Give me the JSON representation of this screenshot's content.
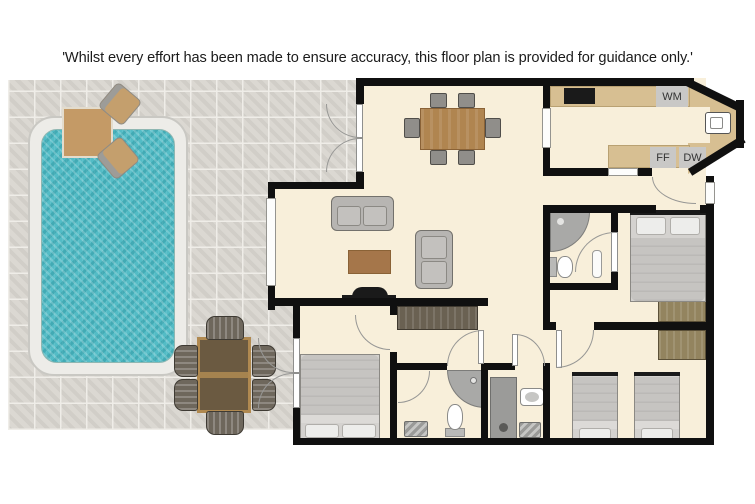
{
  "disclaimer": "'Whilst every effort has been made to ensure accuracy, this floor plan is provided for guidance only.'",
  "labels": {
    "washing_machine": "WM",
    "fridge_freezer": "FF",
    "dishwasher": "DW"
  },
  "colors": {
    "wall": "#101010",
    "floor": "#f8efda",
    "tile": "#dbd8d2",
    "tile_grout": "#efede8",
    "counter": "#d7bf92",
    "water": "#53bcc6",
    "pool_edge": "#edece8",
    "wood": "#b08550",
    "dark_wood": "#6b5a41",
    "furniture_gray": "#b7b5b2",
    "bed_gray": "#c6c4c1",
    "appliance": "#c9c8c6",
    "fixture": "#a9a9a7",
    "wardrobe_olive": "#93845f",
    "wardrobe_dark": "#6a6152"
  }
}
